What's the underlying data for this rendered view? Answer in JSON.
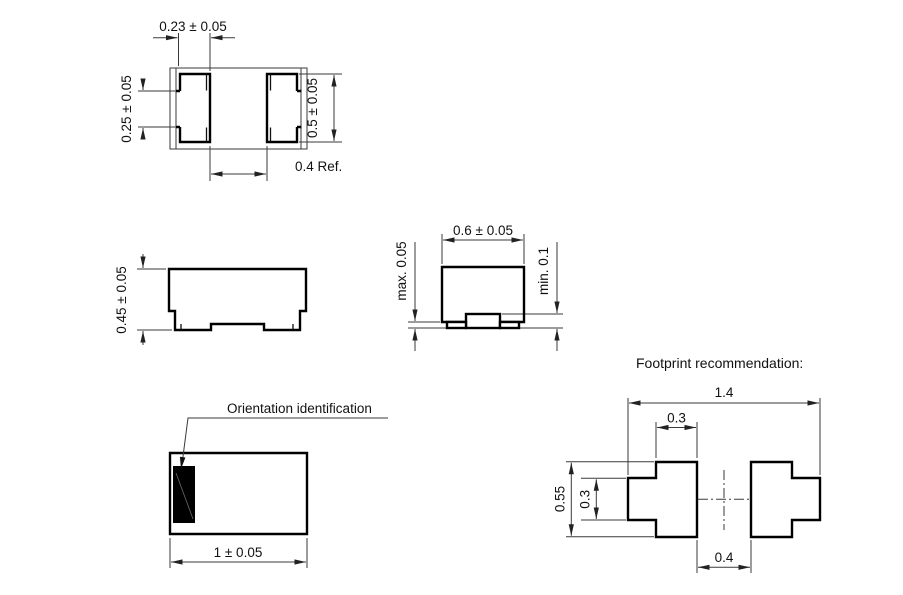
{
  "drawing": {
    "top_view": {
      "dim_terminal_top_width": "0.23 ± 0.05",
      "dim_terminal_notch": "0.25 ± 0.05",
      "dim_terminal_length": "0.5 ± 0.05",
      "dim_terminal_gap": "0.4 Ref."
    },
    "side_view": {
      "dim_height": "0.45 ± 0.05"
    },
    "front_view": {
      "dim_width": "0.6 ± 0.05",
      "dim_standoff_max": "max. 0.05",
      "dim_electrode_min": "min. 0.1"
    },
    "bottom_view": {
      "callout_label": "Orientation identification",
      "dim_length": "1 ± 0.05"
    },
    "footprint": {
      "title": "Footprint recommendation:",
      "dim_overall_width": "1.4",
      "dim_pad_width": "0.3",
      "dim_pad_height": "0.55",
      "dim_pad_notch_height": "0.3",
      "dim_pad_gap": "0.4"
    }
  },
  "colors": {
    "background": "#ffffff",
    "thin_line": "#3a3a3a",
    "outline": "#000000",
    "orientation_mark": "#000000"
  }
}
